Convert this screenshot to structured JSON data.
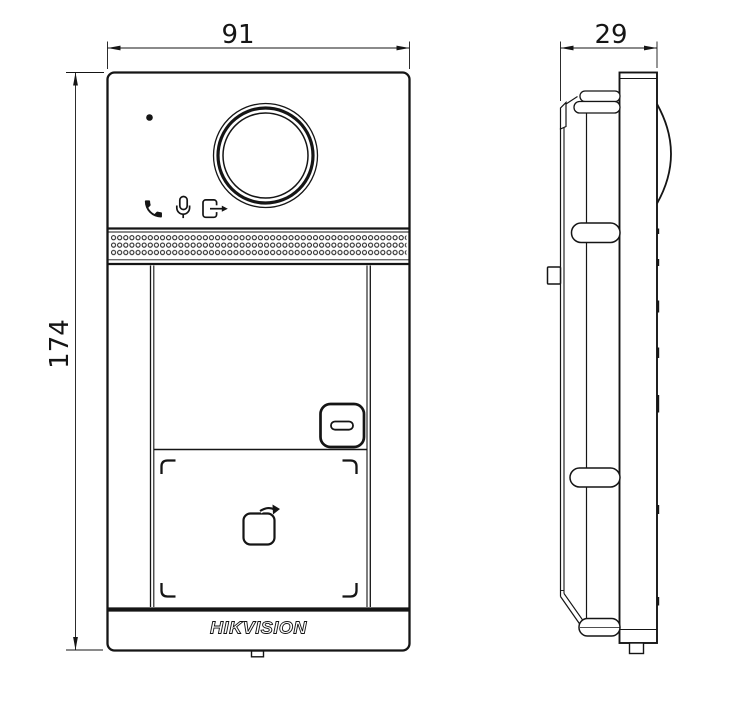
{
  "drawing": {
    "brand_logo": "HIKVISION",
    "front_view": {
      "width_label": "91",
      "height_label": "174",
      "features": [
        "status-led",
        "camera-lens",
        "speaker-grille",
        "call-button",
        "card-reading-area",
        "contactless-card-icon"
      ],
      "icon_row": [
        "handset-icon",
        "microphone-icon",
        "door-exit-icon"
      ]
    },
    "side_view": {
      "depth_label": "29",
      "features": [
        "lens-dome",
        "mounting-clips",
        "rear-box",
        "side-tab"
      ]
    },
    "colors": {
      "line": "#151515",
      "background": "#ffffff"
    }
  }
}
